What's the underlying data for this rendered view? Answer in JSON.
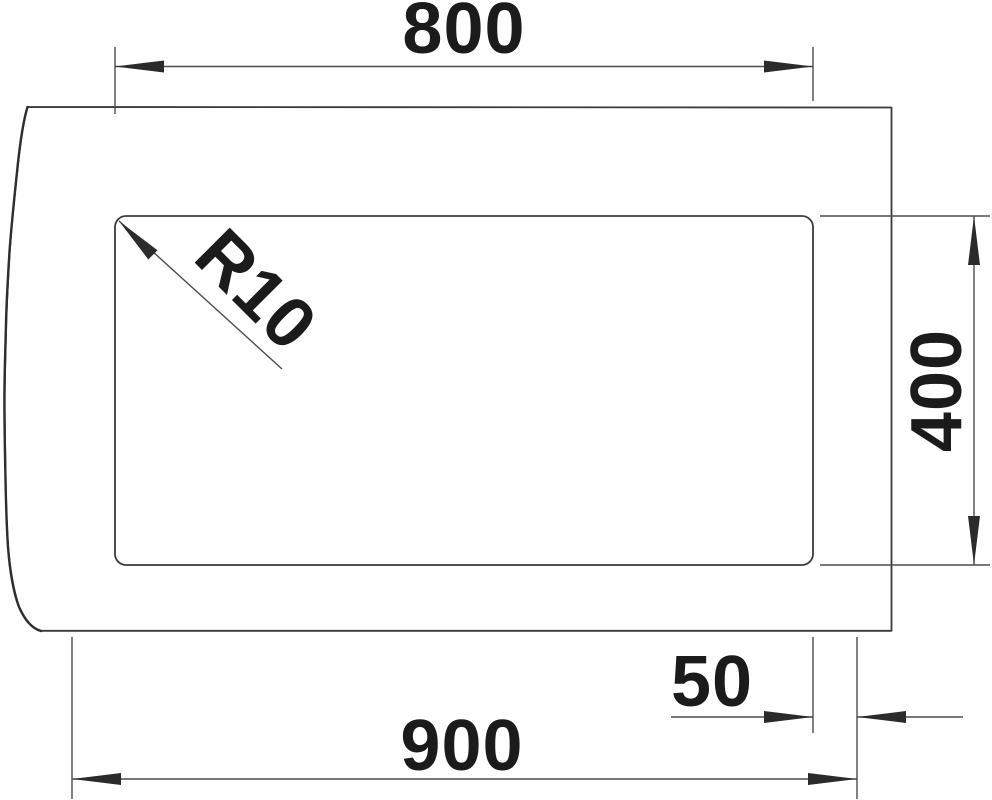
{
  "drawing": {
    "type": "technical-dimension-drawing",
    "colors": {
      "background": "#ffffff",
      "outline": "#3a3a3a",
      "dimension_lines": "#4c4c4c",
      "arrowheads": "#2b2b2b",
      "text": "#1b1b1b"
    },
    "dimensions": {
      "cutout_width": "800",
      "cutout_corner_radius": "R10",
      "cutout_depth": "400",
      "edge_offset": "50",
      "overall_width": "900"
    }
  }
}
